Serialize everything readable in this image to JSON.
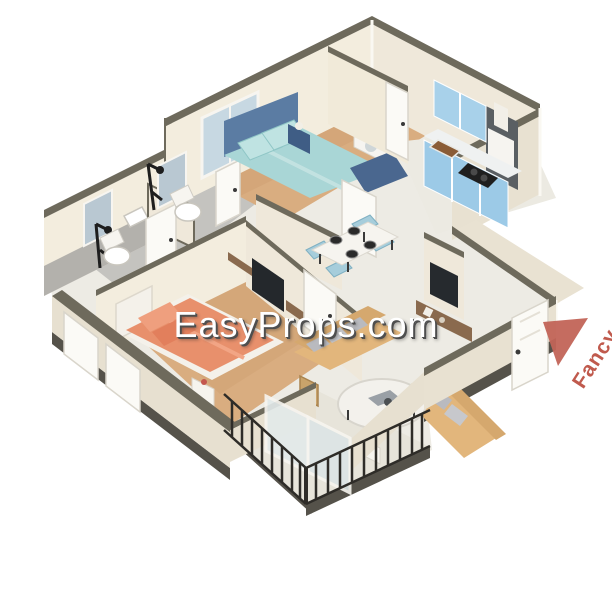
{
  "watermark": {
    "text": "EasyProps.com",
    "color": "#ffffff",
    "shadow_color": "#4e4e4e"
  },
  "corner_logo": {
    "text": "Fancy",
    "color": "#c05a4d",
    "icon": "triangle-icon"
  },
  "palette": {
    "background": "#ffffff",
    "wall_face": "#f3edde",
    "wall_outer": "#e8e1d1",
    "wall_cap": "#6e6a5c",
    "slab_shadow": "#55524a",
    "wood_floor": "#d9ad80",
    "tile_floor": "#edebe4",
    "bath_floor": "#c4c3bf",
    "balcony_floor": "#e7e4da",
    "bed_headboard_blue": "#5b7ca3",
    "bedding_aqua": "#a9d6d6",
    "bedding_salmon": "#e8906c",
    "kitchen_cabinet_blue": "#a8d1ea",
    "sofa_tan": "#e2b67c",
    "dining_chair_blue": "#a6cddb",
    "railing_dark": "#2e2c28",
    "walnut": "#8a6a4e"
  },
  "scene": {
    "type": "isometric 3D cutaway apartment floor plan render",
    "rooms": [
      {
        "id": "bathroom-1",
        "furniture": [
          "wall-hung toilet",
          "washbasin",
          "mirror",
          "black shower set",
          "white door"
        ]
      },
      {
        "id": "bathroom-2",
        "furniture": [
          "wall-hung toilet",
          "washbasin",
          "mirror",
          "black shower set",
          "white door"
        ]
      },
      {
        "id": "bedroom-1",
        "furniture": [
          "double bed with aqua bedding",
          "blue headboard",
          "foot bench",
          "nightstand with lamp",
          "window"
        ]
      },
      {
        "id": "utility-balcony",
        "furniture": [
          "washing machine",
          "black railing"
        ]
      },
      {
        "id": "kitchen",
        "furniture": [
          "light blue upper and lower cabinets",
          "dark tall cabinet panel",
          "sink",
          "gas hob",
          "white range hood",
          "door"
        ]
      },
      {
        "id": "dining-area",
        "furniture": [
          "white table",
          "four light blue chairs",
          "four dark place settings"
        ]
      },
      {
        "id": "living-room",
        "furniture": [
          "two tan sofas with gray pillows",
          "round white coffee table",
          "wall TV with walnut console",
          "side table with red flowers",
          "sliding glass doors"
        ]
      },
      {
        "id": "master-bedroom",
        "furniture": [
          "bed with coral bedding",
          "white headboard",
          "wall TV with walnut shelf",
          "white nightstand",
          "wicker basket",
          "low windows"
        ]
      },
      {
        "id": "balcony",
        "furniture": [
          "dark metal railing"
        ]
      },
      {
        "id": "entry",
        "furniture": [
          "white entrance door"
        ]
      }
    ]
  }
}
